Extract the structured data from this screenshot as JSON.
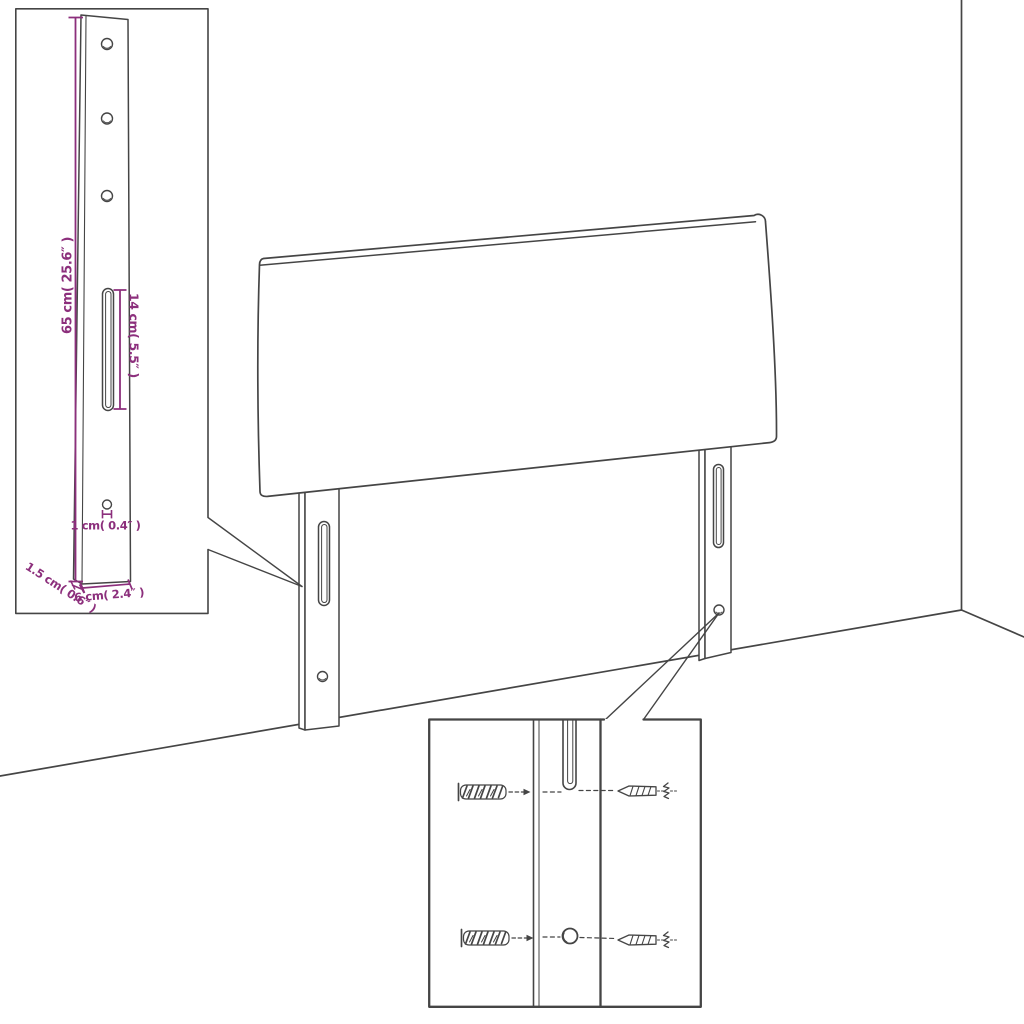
{
  "title": "Headboard wall-mounting dimension diagram",
  "colors": {
    "dimension_text": "#8c2f7c",
    "line_art": "#454545",
    "background": "#ffffff"
  },
  "dimensions": {
    "leg_height": "65 cm( 25.6″ )",
    "slot_length": "14 cm( 5.5″ )",
    "hole_size": "1 cm( 0.4″ )",
    "leg_thickness": "1.5 cm( 0.6″ )",
    "leg_width": "6 cm( 2.4″ )"
  },
  "icons": {
    "wall_plug": "wall-plug-icon",
    "screw": "screw-icon"
  }
}
